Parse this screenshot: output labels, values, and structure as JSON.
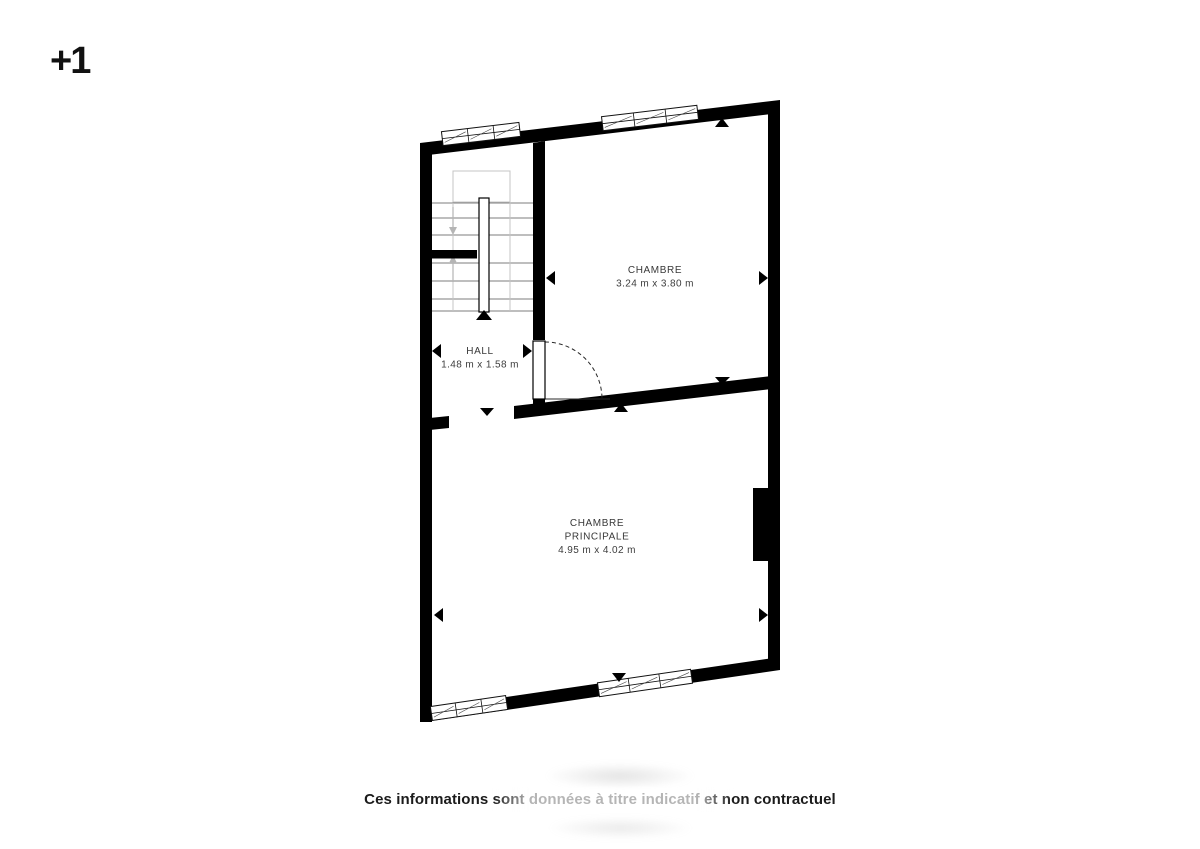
{
  "colors": {
    "background": "#ffffff",
    "wall": "#000000",
    "room_text": "#383838",
    "disclaimer_text": "#1b1b1b",
    "stair_tread": "#7d7d7d",
    "stair_guide": "#c4c4c4",
    "stair_arrow": "#b5b5b5"
  },
  "floor": {
    "label": "+1"
  },
  "plan": {
    "rooms": [
      {
        "name": "CHAMBRE",
        "dimensions": "3.24 m x 3.80 m"
      },
      {
        "name": "HALL",
        "dimensions": "1.48 m x 1.58 m"
      },
      {
        "name_line1": "CHAMBRE",
        "name_line2": "PRINCIPALE",
        "dimensions": "4.95 m x 4.02 m"
      }
    ]
  },
  "footer": {
    "disclaimer": "Ces informations sont données à titre indicatif et non contractuel"
  }
}
